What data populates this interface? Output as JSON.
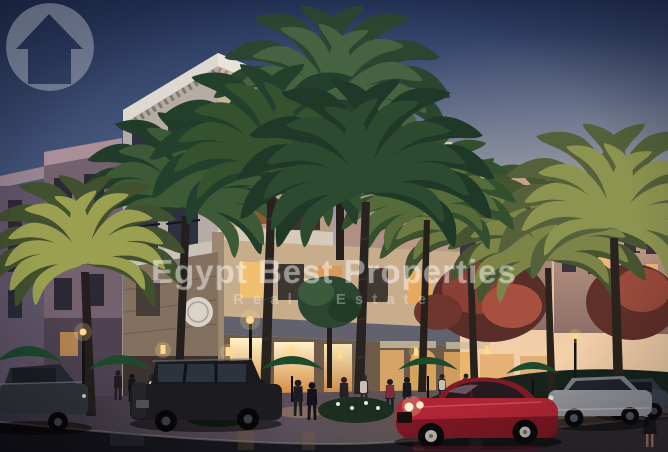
{
  "watermark": {
    "title": "Egypt Best Properties",
    "subtitle": "Real Estate",
    "logo_icon": "house-circle-icon"
  },
  "palette": {
    "sky_top": "#233358",
    "sky_mid": "#7487ae",
    "sky_horizon": "#e8c4b2",
    "sky_gold": "#f7e0ba",
    "building_cream": "#cdb79c",
    "building_shadow": "#75616e",
    "cornice_light": "#e4ddd0",
    "window_glow": "#ffd98c",
    "storefront_glow_top": "#fff2c8",
    "storefront_glow_bottom": "#d4883e",
    "palm_dark": "#22402b",
    "palm_mid": "#35522f",
    "palm_lit": "#8d9450",
    "umbrella_green": "#1d4a2d",
    "asphalt": "#15151b",
    "sidewalk": "#4c4350",
    "car_red": "#b02535",
    "car_silver": "#94969c",
    "car_suv": "#1d1c20",
    "flower_white": "#e9e9dc"
  }
}
